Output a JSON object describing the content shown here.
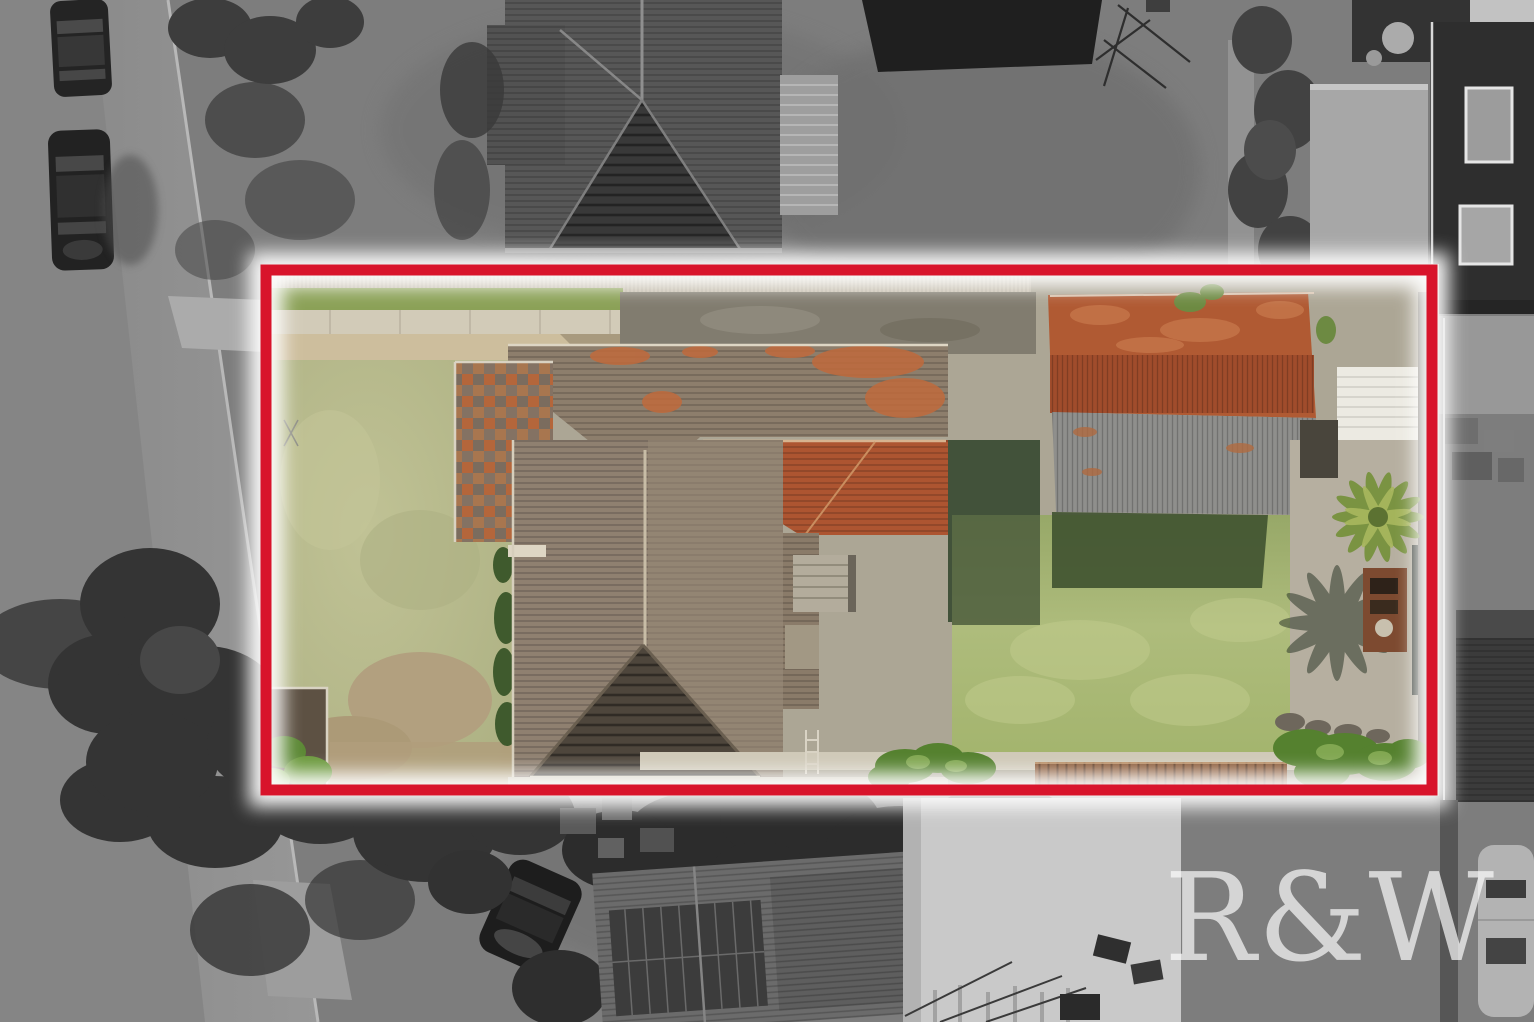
{
  "image": {
    "kind": "aerial-drone-photo",
    "description": "Top-down aerial photograph of a suburban residential property highlighted by a red boundary outline; area inside the boundary is in full colour, surroundings are desaturated grayscale",
    "width_px": 1534,
    "height_px": 1022
  },
  "watermark": {
    "text": "R&W",
    "color": "#ffffff",
    "opacity": 0.68
  },
  "boundary": {
    "color": "#d8142b",
    "glow_color": "#ffffff",
    "stroke_px": 11
  },
  "colors": {
    "bg_gray": "#7d7d7d",
    "street_gray": "#8e8e8e",
    "curb_light": "#b8b8b8",
    "car_dark": "#242424",
    "tree_gray": "#3d3d3d",
    "neighbor_house_roof": "#575757",
    "neighbor_gable_dark": "#393939",
    "pergola_gray": "#9e9e9e",
    "shade_sail": "#1f1f1f",
    "gray_shed": "#a7a7a7",
    "dark_house": "#2e2e2e",
    "window_light": "#9c9c9c",
    "dark_shed": "#3b3b3b",
    "white_shed": "#c9c9c9",
    "caravan_gray": "#b3b3b3",
    "bottom_roof_gray": "#6b6b6b",
    "solar_panel_dark": "#3c3c3c",
    "front_lawn": "#b5b88b",
    "back_lawn": "#a9b878",
    "lawn_shadow": "#42523a",
    "garage_shadow": "#3f5230",
    "driveway_pavers": "#cdbe9d",
    "path_concrete": "#d2cbb8",
    "rear_concrete": "#817c6f",
    "right_concrete": "#b6afa0",
    "fence_corrugated": "#c7bfae",
    "house_roof": "#8d7e6c",
    "house_roof_orange": "#ad5531",
    "house_gable_dark": "#4e463c",
    "roof_patch_orange": "#c06a3c",
    "garage_rust": "#b05a33",
    "garage_rust_dark": "#a04c2c",
    "garage_gray": "#8f8f8c",
    "white_panel": "#eceae2",
    "palm_green": "#7a9342",
    "palm_shadow": "#2f3a2b",
    "bbq_brick": "#7d4a30",
    "deck_timber": "#8a5a38",
    "hedge_green": "#55812f",
    "soil_brown": "#5d5143",
    "dirt_patch": "#b2a07f",
    "steps_concrete": "#b3ac9c",
    "eave_light": "#ded6c4"
  },
  "scene": {
    "inside_property": [
      "front-lawn",
      "paver-driveway",
      "footpath",
      "main-house-roof",
      "orange-hip-roof",
      "dark-front-gable",
      "checkered-roof-wing",
      "rear-concrete-strip",
      "garage-rust-roof",
      "garage-gray-roof",
      "back-lawn",
      "building-shadows",
      "rear-steps",
      "palm-tree",
      "palm-shadow",
      "brick-bbq",
      "timber-deck",
      "hedge-bushes",
      "garden-bed"
    ],
    "surroundings": [
      "street",
      "parked-cars",
      "grass-verge",
      "conifer-trees",
      "neighbor-house-north",
      "pergola",
      "shade-sail",
      "tv-antenna",
      "gray-shed-northeast",
      "dark-two-storey-house",
      "junk-pile",
      "dark-shed-east",
      "neighbor-roof-south",
      "solar-panels",
      "white-shed-south",
      "scaffolding",
      "parked-car-south",
      "caravan"
    ]
  }
}
